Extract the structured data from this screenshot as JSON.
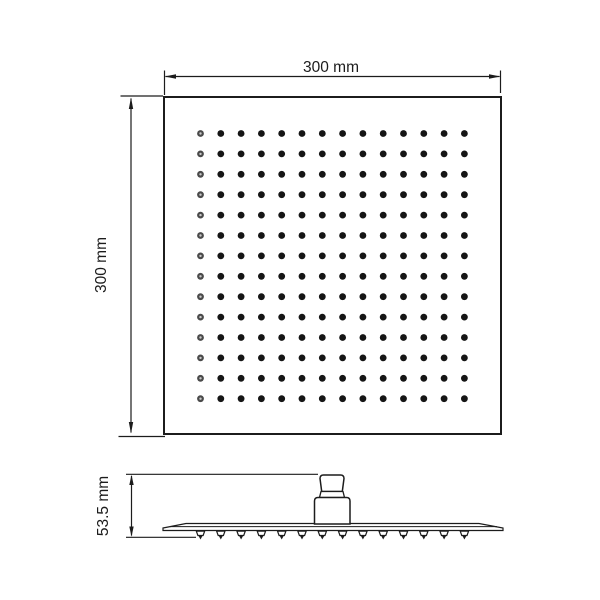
{
  "page": {
    "background_color": "#ffffff",
    "line_color": "#1c1c1c",
    "description_labels": {
      "top_width": "300 mm",
      "top_height": "300 mm",
      "side_height": "53.5 mm"
    }
  },
  "top_view": {
    "square": {
      "x": 164,
      "y": 97,
      "width": 337,
      "height": 337
    },
    "width_dimension": {
      "label": "300 mm"
    },
    "height_dimension": {
      "label": "300 mm"
    },
    "nozzle_grid": {
      "rows": 14,
      "cols": 14,
      "x_start": 200.5,
      "y_start": 133.5,
      "x_step": 20.3,
      "y_step": 20.4,
      "dot_radius": 3.4,
      "dot_color": "#151515",
      "first_column_ring_color": "#4a4a4a",
      "first_column_center_color": "#c9c9c9"
    }
  },
  "side_view": {
    "height_dimension": {
      "label": "53.5 mm"
    },
    "nozzles": {
      "count": 14,
      "x_start": 200.5,
      "x_step": 20.3,
      "y_top": 530.5
    }
  }
}
